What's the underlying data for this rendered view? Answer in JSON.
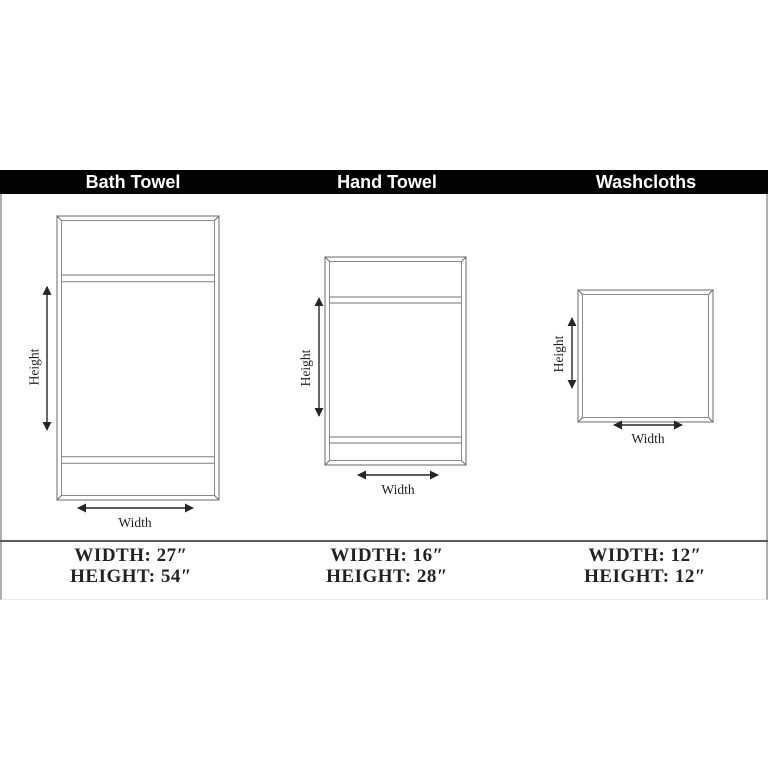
{
  "header": {
    "labels": [
      "Bath Towel",
      "Hand Towel",
      "Washcloths"
    ],
    "bar_color": "#000000",
    "text_color": "#ffffff"
  },
  "diagram": {
    "height_label": "Height",
    "width_label": "Width",
    "frame_color": "#828282",
    "arrow_color": "#262626"
  },
  "items": [
    {
      "name": "Bath Towel",
      "width_text": "WIDTH: 27″",
      "height_text": "HEIGHT: 54″",
      "width_inches": 27,
      "height_inches": 54
    },
    {
      "name": "Hand Towel",
      "width_text": "WIDTH: 16″",
      "height_text": "HEIGHT: 28″",
      "width_inches": 16,
      "height_inches": 28
    },
    {
      "name": "Washcloths",
      "width_text": "WIDTH: 12″",
      "height_text": "HEIGHT: 12″",
      "width_inches": 12,
      "height_inches": 12
    }
  ]
}
